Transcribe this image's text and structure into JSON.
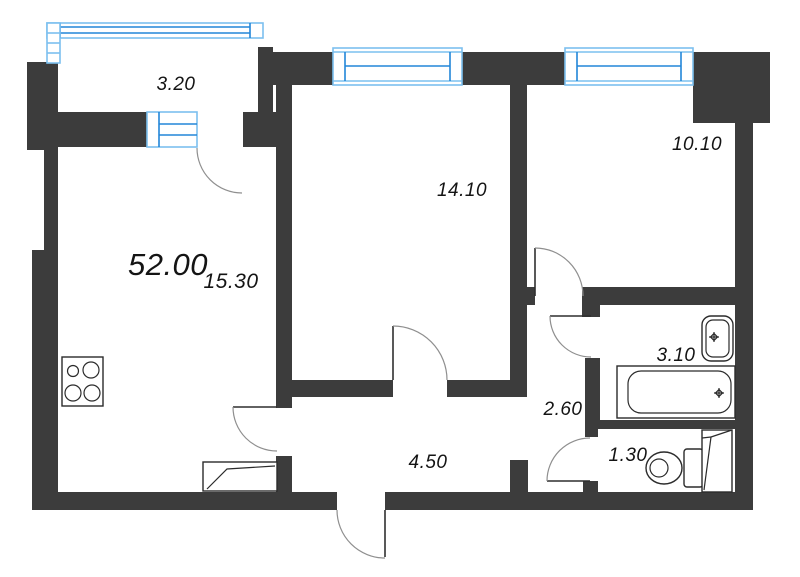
{
  "plan": {
    "title": "apartment-floor-plan",
    "total_area": "52.00",
    "rooms": {
      "balcony": {
        "name": "balcony",
        "area": "3.20"
      },
      "bedroom_1": {
        "name": "room",
        "area": "14.10"
      },
      "bedroom_2": {
        "name": "room",
        "area": "10.10"
      },
      "living_room": {
        "name": "kitchen-living",
        "area": "15.30"
      },
      "bathroom": {
        "name": "bathroom",
        "area": "3.10"
      },
      "hallway": {
        "name": "hallway",
        "area": "2.60"
      },
      "wc": {
        "name": "wc",
        "area": "1.30"
      },
      "corridor": {
        "name": "corridor",
        "area": "4.50"
      }
    },
    "fixtures": [
      "stove",
      "wardrobe",
      "bathtub",
      "sink",
      "toilet",
      "water-heater"
    ],
    "openings": [
      "balcony-door",
      "living-room-door",
      "bedroom-1-door",
      "bedroom-2-door",
      "bathroom-door",
      "wc-door",
      "entrance-door"
    ],
    "windows": [
      "balcony-glazing",
      "bedroom-1-window",
      "bedroom-2-window",
      "balcony-window-unit"
    ],
    "colors": {
      "wall": "#3c3c3c",
      "window_frame": "#7cc0ef",
      "window_glass": "#2286d8",
      "door_arc": "#8f8f8f",
      "label_text": "#141414"
    }
  }
}
